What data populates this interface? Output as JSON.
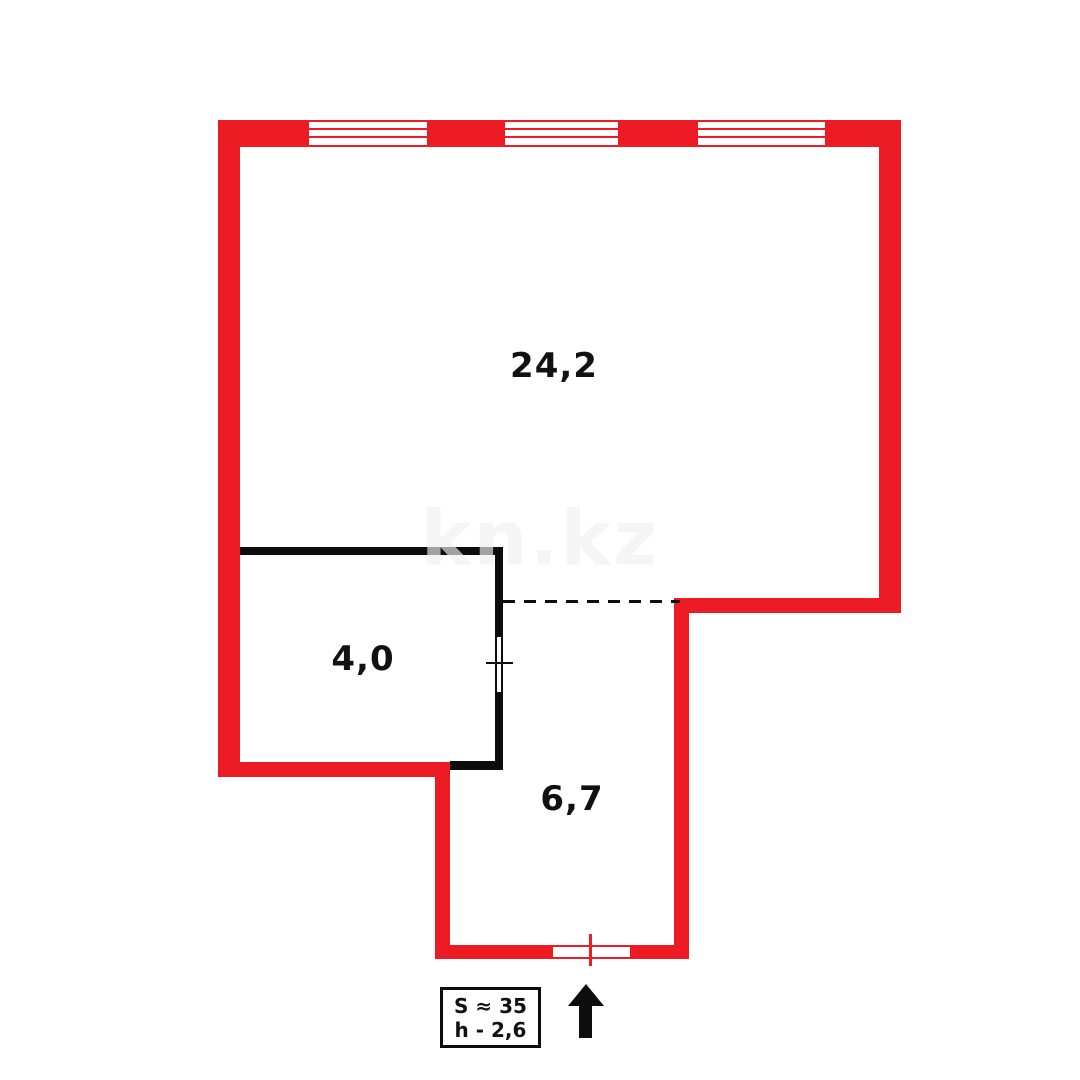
{
  "watermark": {
    "text": "kn.kz"
  },
  "rooms": {
    "living": {
      "area_label": "24,2"
    },
    "storage": {
      "area_label": "4,0"
    },
    "hallway": {
      "area_label": "6,7"
    }
  },
  "legend": {
    "total_area": "S ≈ 35",
    "ceiling_height": "h - 2,6"
  },
  "icons": {
    "entrance_arrow": "up-arrow"
  },
  "colors": {
    "outer_wall": "#ed1c24",
    "partition_wall": "#0d0d0d",
    "text": "#111111",
    "watermark": "#f0f0f0",
    "background": "#ffffff"
  }
}
